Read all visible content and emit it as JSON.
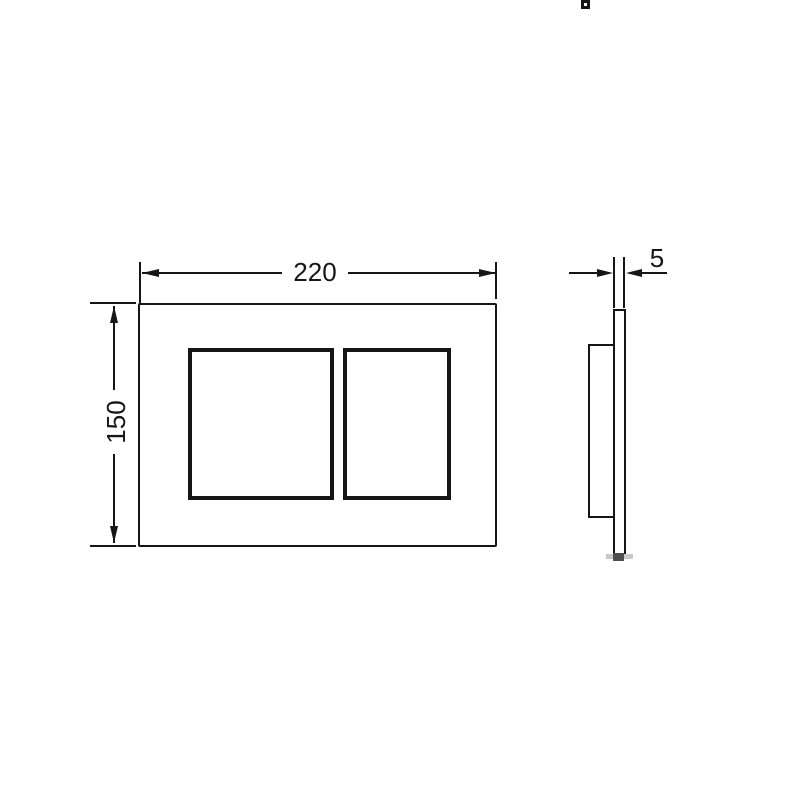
{
  "drawing": {
    "type": "technical-drawing",
    "subject": "flush-plate-two-buttons",
    "line_color": "#161616",
    "background_color": "#ffffff"
  },
  "front_view": {
    "width_dimension": {
      "label": "220"
    },
    "height_dimension": {
      "label": "150"
    }
  },
  "side_view": {
    "thickness_dimension": {
      "label": "5"
    },
    "teeth_count": 7
  }
}
